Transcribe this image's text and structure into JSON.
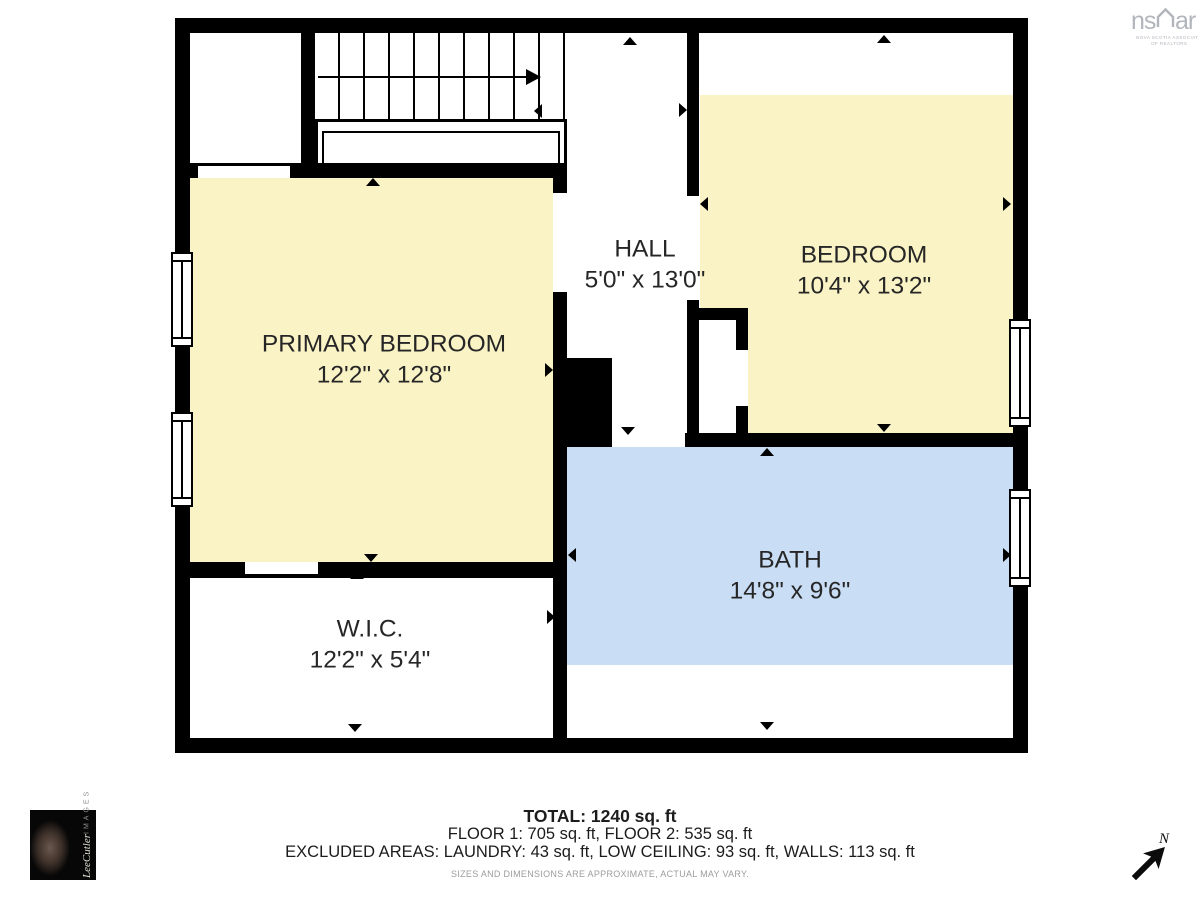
{
  "rooms": [
    {
      "id": "primary-bedroom",
      "name": "PRIMARY BEDROOM",
      "dims": "12'2\" x 12'8\""
    },
    {
      "id": "bedroom",
      "name": "BEDROOM",
      "dims": "10'4\" x 13'2\""
    },
    {
      "id": "hall",
      "name": "HALL",
      "dims": "5'0\" x 13'0\""
    },
    {
      "id": "bath",
      "name": "BATH",
      "dims": "14'8\" x 9'6\""
    },
    {
      "id": "wic",
      "name": "W.I.C.",
      "dims": "12'2\" x 5'4\""
    }
  ],
  "summary": {
    "total": "TOTAL: 1240 sq. ft",
    "floors": "FLOOR 1: 705 sq. ft, FLOOR 2: 535 sq. ft",
    "excluded": "EXCLUDED AREAS: LAUNDRY: 43 sq. ft, LOW CEILING: 93 sq. ft, WALLS: 113 sq. ft",
    "disclaimer": "SIZES AND DIMENSIONS ARE APPROXIMATE, ACTUAL MAY VARY."
  },
  "branding": {
    "nsar_left": "ns",
    "nsar_right": "ar",
    "nsar_tagline1": "NOVA SCOTIA ASSOCIATION",
    "nsar_tagline2": "OF REALTORS",
    "photographer_name": "LeeCutler",
    "photographer_word": "IMAGES",
    "north_label": "N"
  },
  "colors": {
    "room_yellow": "#FAF3C6",
    "room_blue": "#C9DDF5",
    "wall": "#000000",
    "label_text": "#262626",
    "logo_gray": "#B2B6BC"
  }
}
